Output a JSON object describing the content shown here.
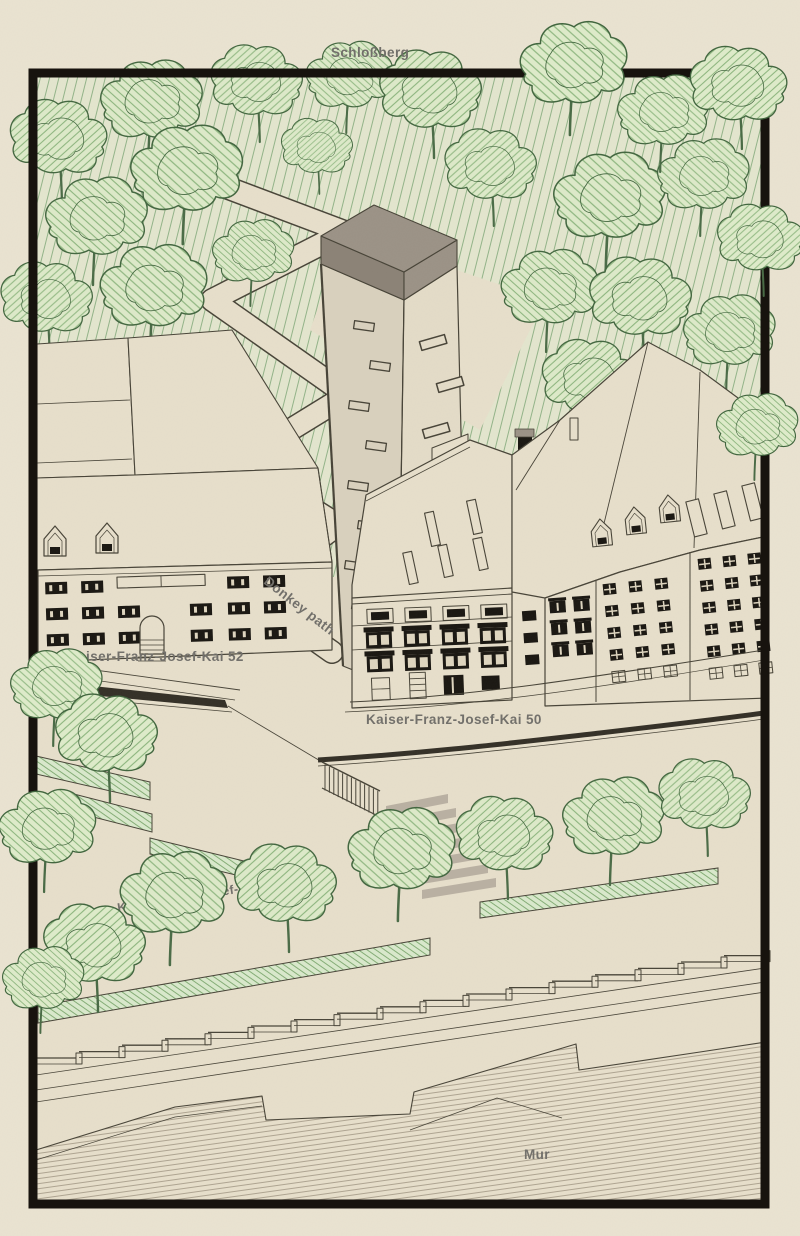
{
  "labels": {
    "hill": "Schloßberg",
    "path": "Donkey path",
    "kai52": "Kaiser-Franz-Josef-Kai 52",
    "kai50": "Kaiser-Franz-Josef-Kai 50",
    "kai_street": "Kaiser-Franz-Josef-Kai",
    "river": "Mur"
  },
  "colors": {
    "paper": "#eae3d1",
    "paper_inner": "#e7dfcb",
    "frame": "#17130e",
    "ink": "#474337",
    "label": "#716f6a",
    "hill_bg": "#e3e6ce",
    "hill_line": "#92b388",
    "tree_bg": "#ddeac9",
    "tree_line": "#8cb57e",
    "tree_outline": "#42663f",
    "trunk": "#4a6b46",
    "roof_top": "#9b9286",
    "roof_side": "#8b8276",
    "face_left": "#d9d1be",
    "face_right": "#e4dcc8",
    "window_dark": "#191611",
    "window_pane": "#ded5bf",
    "rail_dark": "#332f26",
    "bed_bg": "#d9e9cc",
    "bed_line": "#84ad76",
    "river_line": "#a79d8a",
    "steps_gray": "#b3aa9c"
  }
}
